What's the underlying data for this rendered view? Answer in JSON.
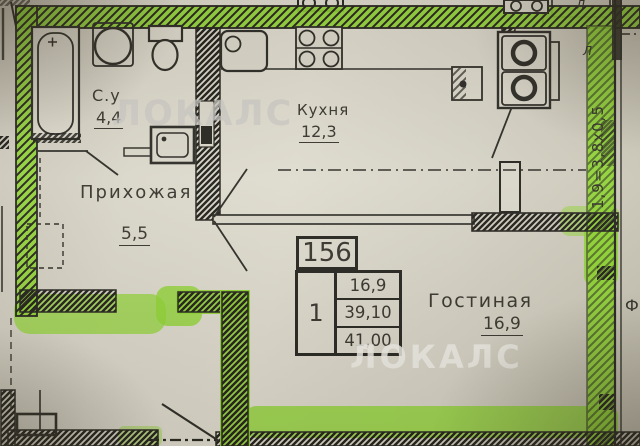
{
  "plan": {
    "rooms": [
      {
        "name": "С.у",
        "area": "4,4"
      },
      {
        "name": "Прихожая",
        "area": "5,5"
      },
      {
        "name": "Кухня",
        "area": "12,3"
      },
      {
        "name": "Гостиная",
        "area": "16,9"
      }
    ],
    "stamp": {
      "number": "156",
      "room_count": "1",
      "area_living": "16,9",
      "area_total": "39,10",
      "area_with_loggia": "41,00"
    },
    "annotations": {
      "loggia_dimension": "1,9=3,8х0,5",
      "neighbor_top_right": "Л",
      "loggia_mark": "Л",
      "right_edge": "Ф"
    }
  },
  "watermark": {
    "text": "ЛОКАЛС"
  },
  "colors": {
    "highlight_green": "#8dd331",
    "paper": "#d8d5c9",
    "ink": "#2a2924",
    "watermark_gray": "#c8c7c3"
  }
}
